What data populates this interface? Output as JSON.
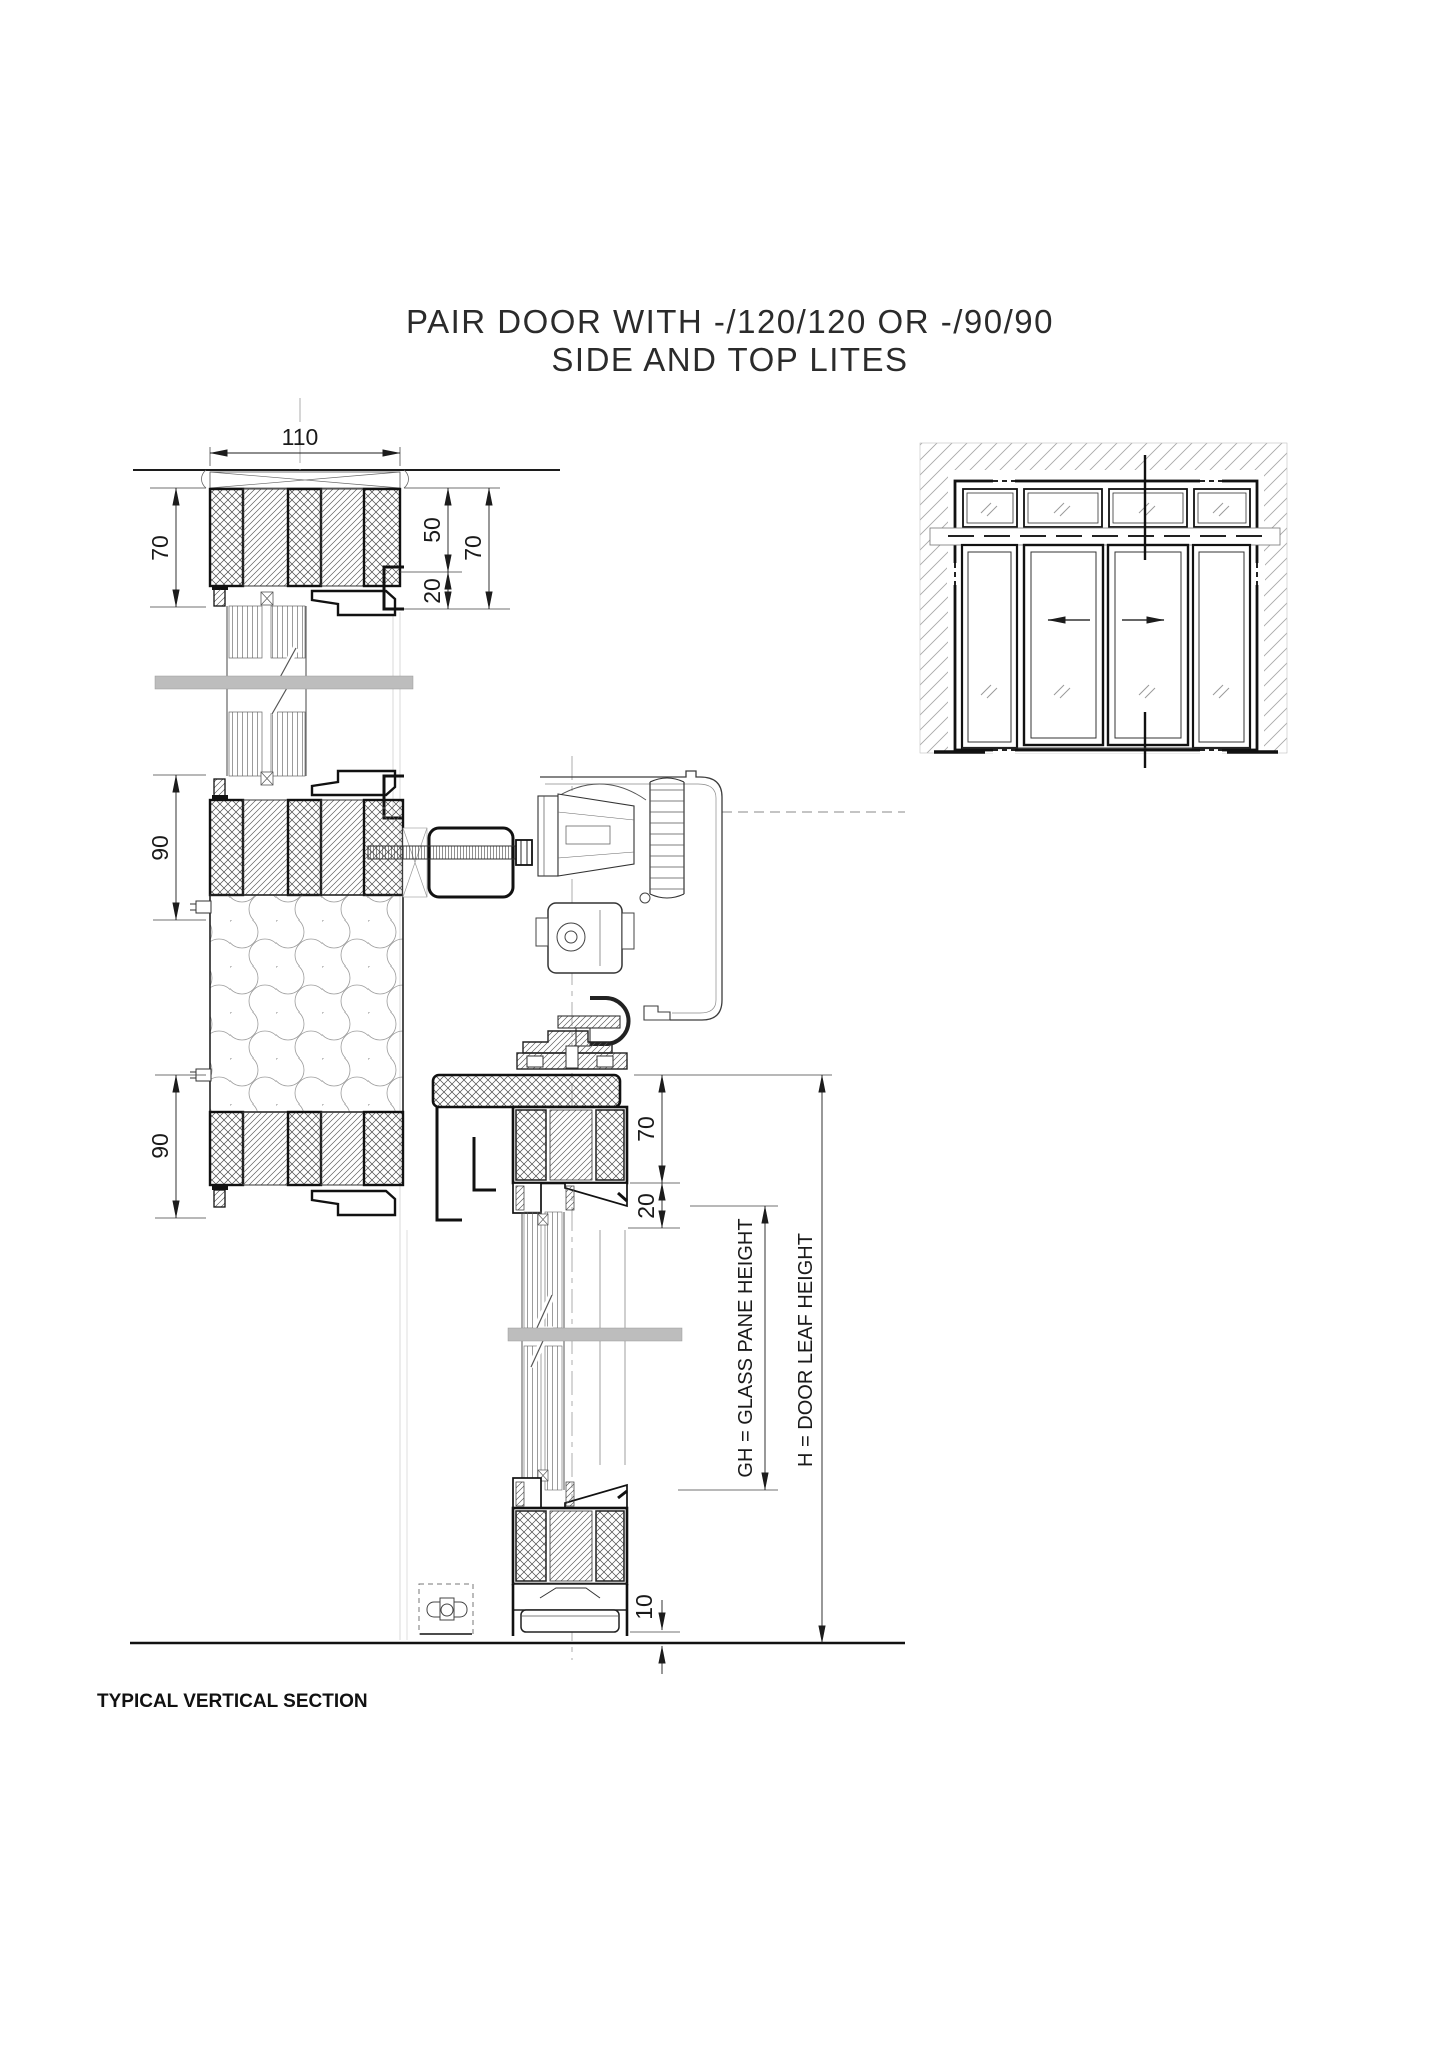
{
  "title": {
    "line1": "PAIR DOOR WITH -/120/120 OR -/90/90",
    "line2": "SIDE AND TOP LITES"
  },
  "caption": "TYPICAL VERTICAL SECTION",
  "section": {
    "dims": {
      "frame_width": "110",
      "head_height": "70",
      "head_upper": "50",
      "head_bead": "20",
      "head_total": "70",
      "transom_upper": "90",
      "transom_lower": "90",
      "leaf_top_rail": "70",
      "leaf_top_bead": "20",
      "floor_gap": "10"
    },
    "labels": {
      "glass_pane_height": "GH = GLASS PANE HEIGHT",
      "door_leaf_height": "H = DOOR LEAF HEIGHT"
    }
  },
  "colors": {
    "line": "#1c1c1c",
    "break_band": "#bdbdbd",
    "hatch": "#8a8a8a",
    "background": "#ffffff"
  }
}
